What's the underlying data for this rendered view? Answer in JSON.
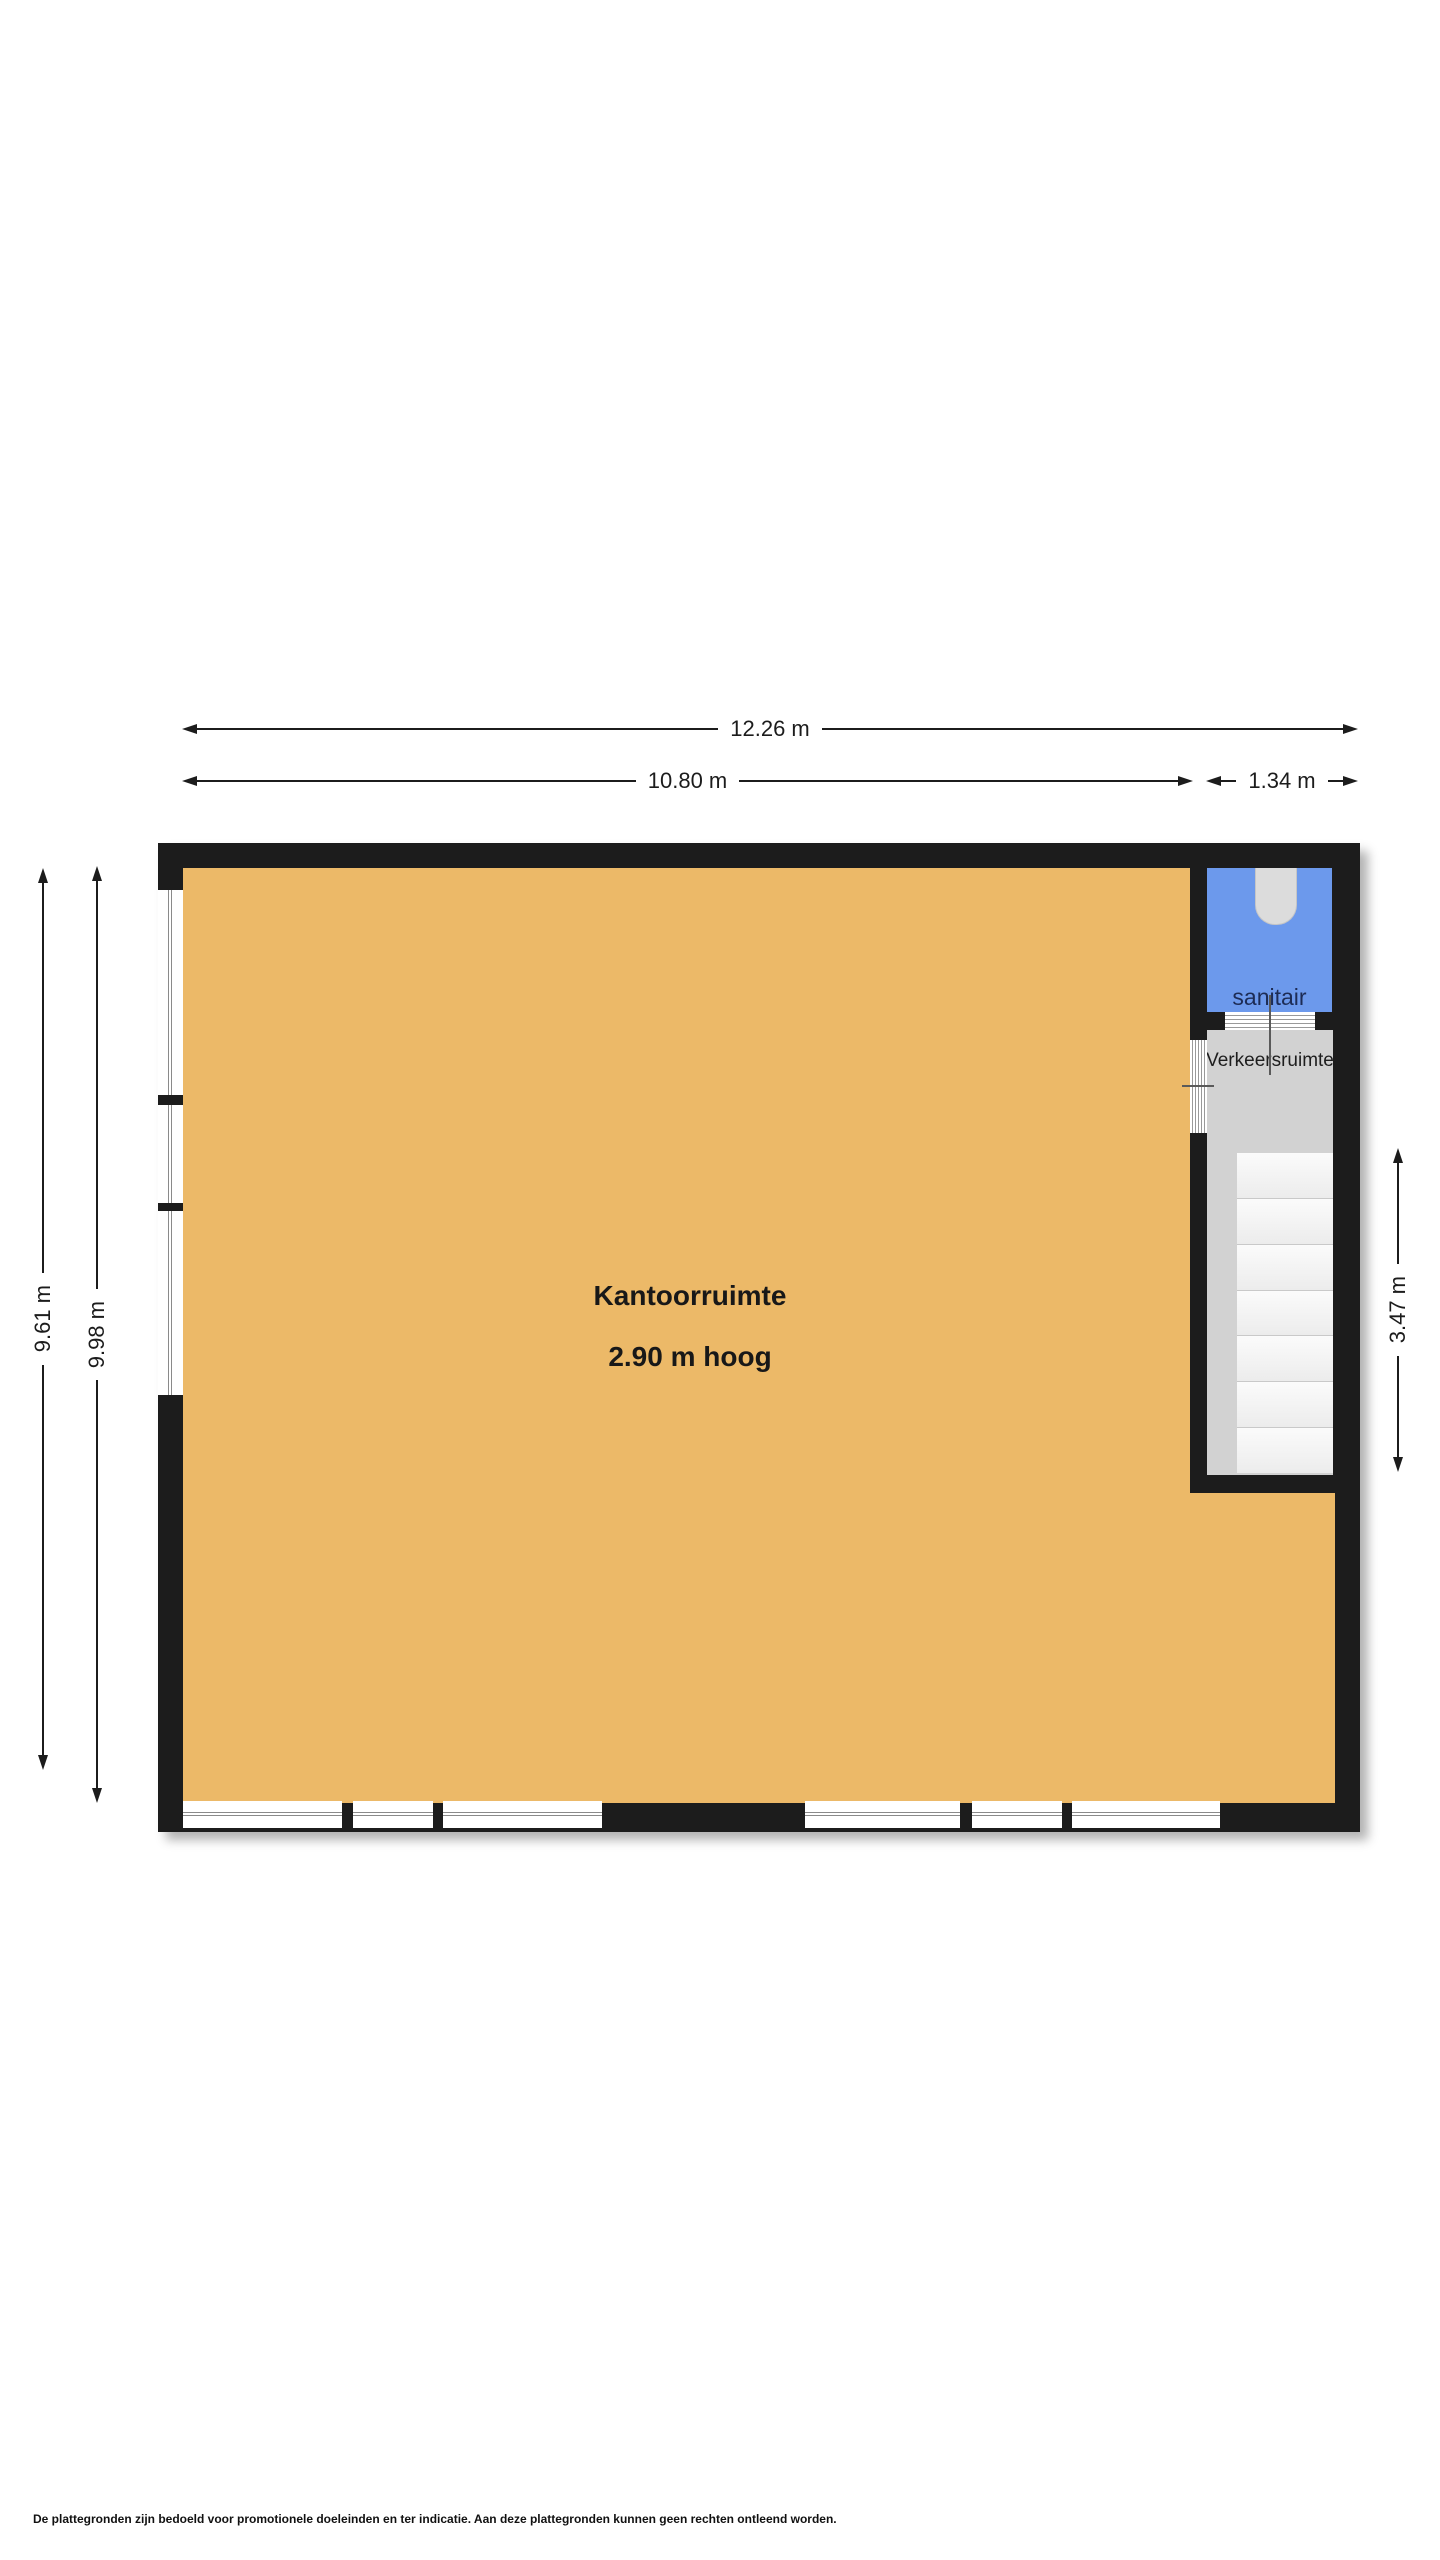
{
  "floorplan": {
    "rooms": {
      "kantoorruimte": {
        "label": "Kantoorruimte",
        "height_label": "2.90 m hoog",
        "floor_color": "#ecb968"
      },
      "sanitair": {
        "label": "sanitair",
        "floor_color": "#6c99ec",
        "label_color": "#1d2c55"
      },
      "verkeersruimte": {
        "label": "Verkeersruimte",
        "floor_color": "#d2d2d2"
      }
    },
    "dimensions": {
      "total_width": "12.26 m",
      "main_width": "10.80 m",
      "column_width": "1.34 m",
      "left_inner_height": "9.61 m",
      "left_outer_height": "9.98 m",
      "stair_zone_height": "3.47 m"
    },
    "stairs": {
      "treads": 7
    },
    "colors": {
      "wall": "#1c1c1c",
      "window": "#ffffff",
      "stair_tread": "#f4f4f4",
      "dimension_line": "#1c1c1c"
    }
  },
  "disclaimer": "De plattegronden zijn bedoeld voor promotionele doeleinden en ter indicatie. Aan deze plattegronden kunnen geen rechten ontleend worden."
}
